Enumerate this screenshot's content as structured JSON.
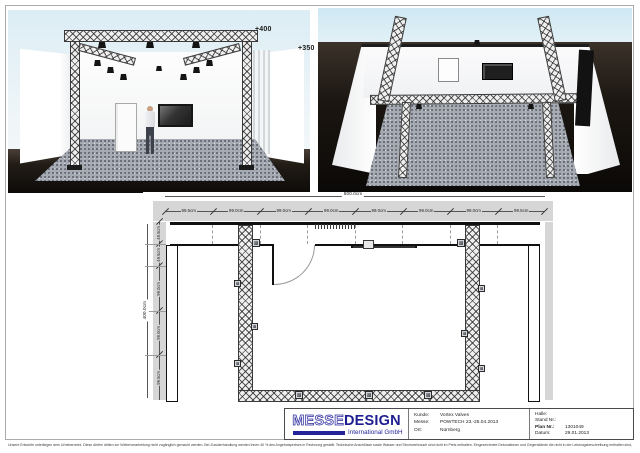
{
  "renders": {
    "front": {
      "height_label_truss": "+400",
      "height_label_wall": "+350"
    }
  },
  "floorplan": {
    "total_width": "800.0cm",
    "total_height": "400.0cm",
    "dims_top": [
      "99.5cm",
      "99.0cm",
      "99.0cm",
      "99.0cm",
      "99.0cm",
      "99.0cm",
      "99.0cm",
      "99.5cm"
    ],
    "dims_left": [
      "49.5cm",
      "49.5cm",
      "99.0cm",
      "99.0cm",
      "99.5cm"
    ]
  },
  "titleblock": {
    "logo": {
      "part1": "MESSE",
      "part2": "DESIGN",
      "subtitle": "International GmbH",
      "brand_color": "#23239a"
    },
    "kunde_label": "Kunde:",
    "kunde_value": "Vortex Valves",
    "messe_label": "Messe:",
    "messe_value": "POWTECH 23.-25.04.2013",
    "ort_label": "Ort:",
    "ort_value": "Nürnberg",
    "halle_label": "Halle:",
    "halle_value": "",
    "stand_label": "Stand Nr.:",
    "stand_value": "",
    "plan_label": "Plan Nr.:",
    "plan_value": "1301049",
    "datum_label": "Datum:",
    "datum_value": "29.01.2013"
  },
  "footer": {
    "disclaimer": "Unsere Entwürfe unterliegen dem Urheberrecht. Diese dürfen dritten zur Weiterverarbeitung nicht zugänglich gemacht werden. Bei Zuwiderhandlung werden Ihnen 40 % des Angebotspreises in Rechnung gestellt. Technische Anschlüsse sowie Wasser und Stromverbrauch sind nicht im Preis enthalten. Eingezeichnete Dekorationen und Gegenstände die nicht in der Leistungsbeschreibung enthalten sind, gehören nicht zum Lieferumfang. Änderungen durch die Messe bleiben vorbehalten."
  }
}
